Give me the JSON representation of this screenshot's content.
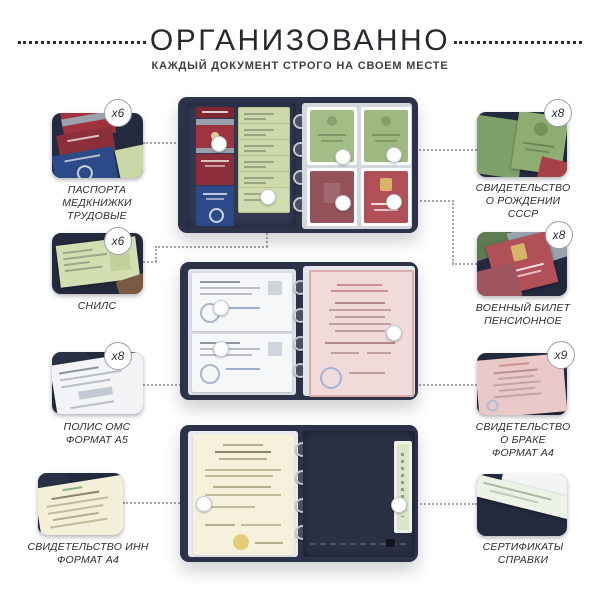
{
  "header": {
    "title": "ОРГАНИЗОВАННО",
    "subtitle": "КАЖДЫЙ ДОКУМЕНТ СТРОГО НА СВОЕМ МЕСТЕ"
  },
  "left_items": [
    {
      "count": "x6",
      "lines": [
        "ПАСПОРТА",
        "МЕДКНИЖКИ",
        "ТРУДОВЫЕ"
      ]
    },
    {
      "count": "x6",
      "lines": [
        "СНИЛС"
      ]
    },
    {
      "count": "x8",
      "lines": [
        "ПОЛИС ОМС",
        "ФОРМАТ А5"
      ]
    },
    {
      "count": "",
      "lines": [
        "СВИДЕТЕЛЬСТВО ИНН",
        "ФОРМАТ А4"
      ]
    }
  ],
  "right_items": [
    {
      "count": "x8",
      "lines": [
        "СВИДЕТЕЛЬСТВО",
        "О РОЖДЕНИИ",
        "СССР"
      ]
    },
    {
      "count": "x8",
      "lines": [
        "ВОЕННЫЙ БИЛЕТ",
        "ПЕНСИОННОЕ"
      ]
    },
    {
      "count": "x9",
      "lines": [
        "СВИДЕТЕЛЬСТВО",
        "О БРАКЕ",
        "ФОРМАТ А4"
      ]
    },
    {
      "count": "",
      "lines": [
        "СЕРТИФИКАТЫ",
        "СПРАВКИ"
      ]
    }
  ],
  "colors": {
    "binder_navy": "#2c3247",
    "passport_red": "#9f3340",
    "passport_blue": "#2d4a88",
    "snils_green": "#cdd9ab",
    "ussr_green": "#9db97f",
    "pension_red": "#b2505a",
    "marriage_pink": "#f1dada",
    "inn_cream": "#f6f1dd"
  }
}
